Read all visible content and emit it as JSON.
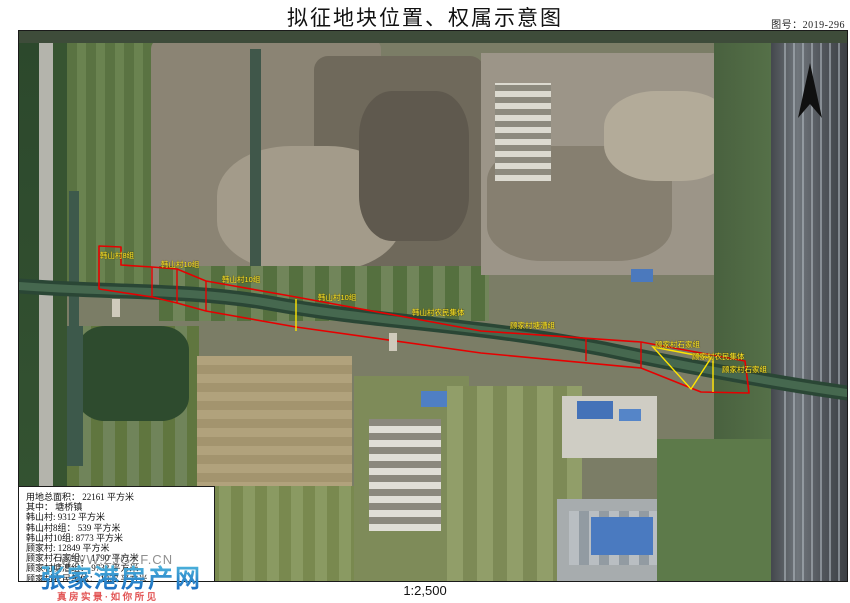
{
  "header": {
    "title": "拟征地块位置、权属示意图",
    "figure_label": "图号：2019-296"
  },
  "map": {
    "scale_text": "1:2,500",
    "boundary_color": "#e60000",
    "subparcel_color": "#ffe400",
    "label_color": "#ffe92a",
    "north_arrow": "north-arrow",
    "parcel_labels": [
      {
        "text": "韩山村8组",
        "x": 81,
        "y": 221
      },
      {
        "text": "韩山村10组",
        "x": 142,
        "y": 230
      },
      {
        "text": "韩山村10组",
        "x": 203,
        "y": 245
      },
      {
        "text": "韩山村10组",
        "x": 299,
        "y": 263
      },
      {
        "text": "韩山村农民集体",
        "x": 393,
        "y": 278
      },
      {
        "text": "顾家村塘漕组",
        "x": 491,
        "y": 291
      },
      {
        "text": "顾家村石家组",
        "x": 636,
        "y": 310
      },
      {
        "text": "顾家村农民集体",
        "x": 673,
        "y": 322
      },
      {
        "text": "顾家村石家组",
        "x": 703,
        "y": 335
      }
    ]
  },
  "info_box": {
    "lines": [
      "用地总面积： 22161 平方米",
      "其中： 塘桥镇",
      "韩山村: 9312 平方米",
      "韩山村8组： 539 平方米",
      "韩山村10组: 8773 平方米",
      "顾家村: 12849 平方米",
      "顾家村石家组： 1790 平方米",
      "顾家村塘漕组： 9732 平方米",
      "顾家村农民集体： 1327 平方米"
    ]
  },
  "watermark": {
    "url": "WWW.ZJGZF.CN",
    "site_name": "张家港房产网",
    "tagline": "真房实景·如你所见"
  }
}
